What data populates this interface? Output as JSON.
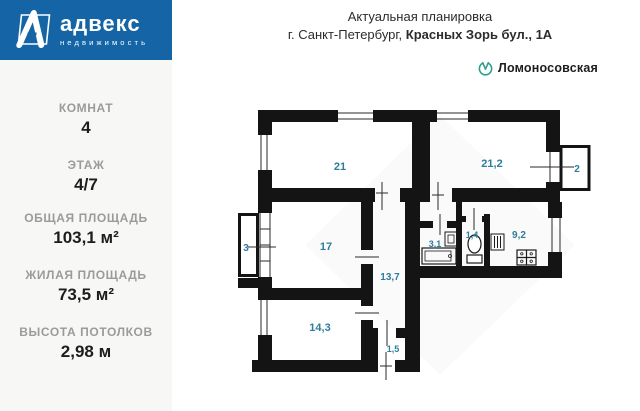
{
  "brand": {
    "name": "адвекс",
    "tagline": "недвижимость"
  },
  "header": {
    "title": "Актуальная планировка",
    "address_prefix": "г. Санкт-Петербург, ",
    "address_bold": "Красных Зорь бул., 1А",
    "metro_station": "Ломоносовская"
  },
  "sidebar": {
    "items": [
      {
        "label": "КОМНАТ",
        "value": "4"
      },
      {
        "label": "ЭТАЖ",
        "value": "4/7"
      },
      {
        "label": "ОБЩАЯ ПЛОЩАДЬ",
        "value": "103,1 м²"
      },
      {
        "label": "ЖИЛАЯ ПЛОЩАДЬ",
        "value": "73,5 м²"
      },
      {
        "label": "ВЫСОТА ПОТОЛКОВ",
        "value": "2,98 м"
      }
    ]
  },
  "plan": {
    "rooms": [
      {
        "name": "living-room-1",
        "area": "21"
      },
      {
        "name": "living-room-2",
        "area": "21,2"
      },
      {
        "name": "balcony-right",
        "area": "2"
      },
      {
        "name": "balcony-left",
        "area": "3"
      },
      {
        "name": "living-room-3",
        "area": "17"
      },
      {
        "name": "corridor",
        "area": "13,7"
      },
      {
        "name": "living-room-4",
        "area": "14,3"
      },
      {
        "name": "vestibule",
        "area": "1,5"
      },
      {
        "name": "bathroom",
        "area": "3,1"
      },
      {
        "name": "wc",
        "area": "1,4"
      },
      {
        "name": "kitchen",
        "area": "9,2"
      }
    ]
  },
  "colors": {
    "brand_blue": "#1565a6",
    "panel_gray": "#f7f7f6",
    "label_gray": "#9b9b9b",
    "room_label_teal": "#2e7d9c",
    "metro_green": "#2f9e8f",
    "wall_black": "#141414"
  }
}
